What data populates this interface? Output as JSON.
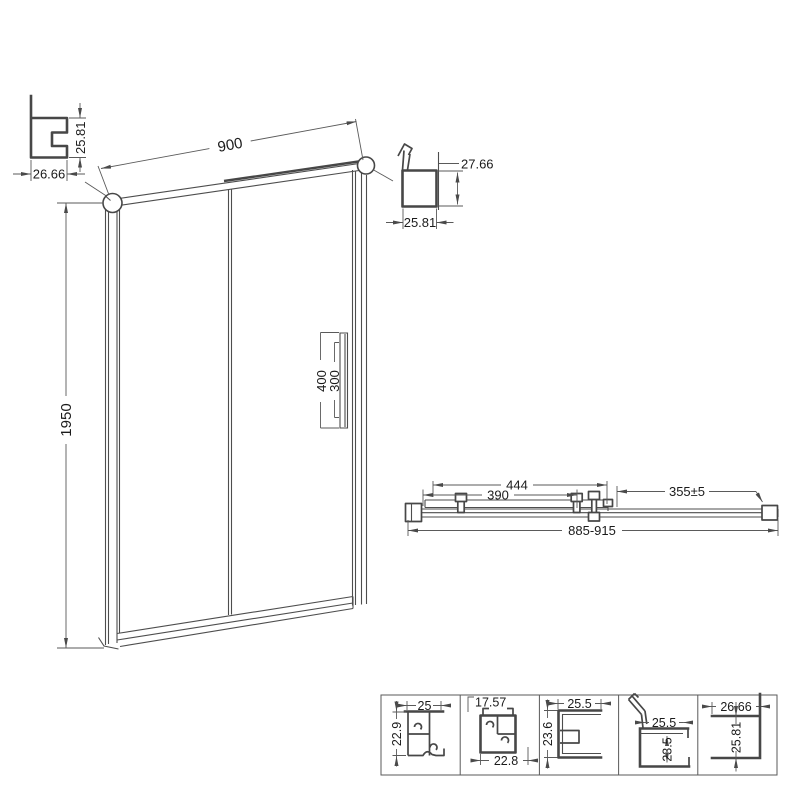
{
  "labels": {
    "wall_profile": {
      "width": "26.66",
      "height": "25.81"
    },
    "frame_width": "900",
    "rail_profile": {
      "height": "27.66",
      "width": "25.81"
    },
    "door": {
      "height": "1950",
      "handle_length": "400",
      "handle_holes": "300"
    },
    "plan": {
      "glass": "444",
      "clips": "390",
      "slide": "355±5",
      "overall": "885-915"
    },
    "profiles": [
      {
        "top": "25",
        "side": "22.9"
      },
      {
        "top": "17.57",
        "bottom": "22.8"
      },
      {
        "top": "25.5",
        "side": "23.6"
      },
      {
        "top": "25.5",
        "side": "23.5"
      },
      {
        "top": "26.66",
        "side": "25.81"
      }
    ]
  }
}
